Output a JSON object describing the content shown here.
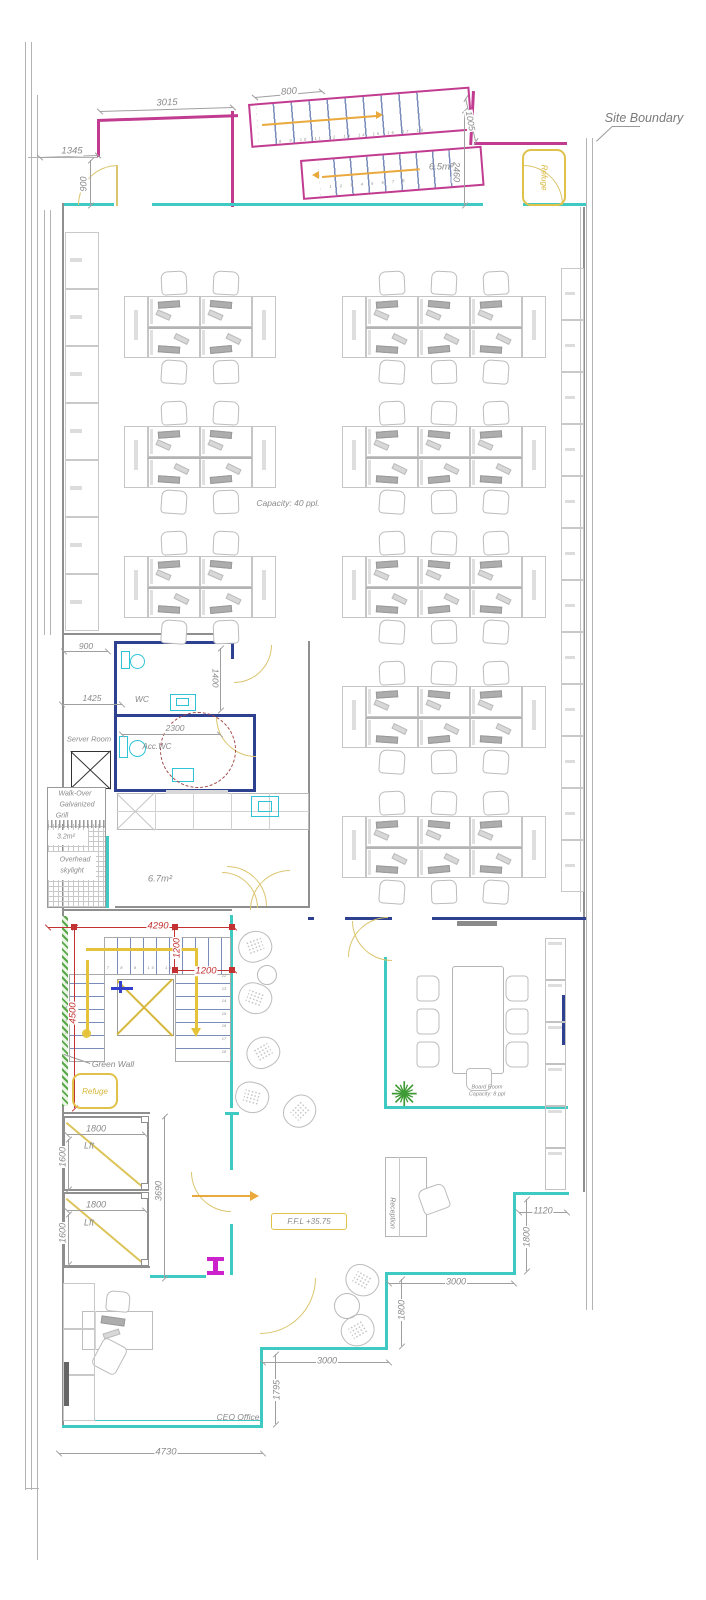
{
  "drawing": {
    "type": "office-floor-plan",
    "level_note": "F.F.L +35.75"
  },
  "boxes": {
    "refuge_top": {
      "label": "Refuge"
    },
    "refuge_stair": {
      "label": "Refuge"
    },
    "ffl": {
      "label": "F.F.L +35.75"
    }
  },
  "colors": {
    "glazing_teal": "#3ec9c2",
    "partition_navy": "#2e4090",
    "stair_pink": "#c13c90",
    "tread_blue": "#7a8cba",
    "door_yellow": "#dbc56e",
    "accent_yellow": "#d8b73a",
    "arrow_orange": "#e9a93d",
    "dim_red": "#c23232",
    "green_wall": "#3f9b35",
    "fixture_cyan": "#2ec4d6",
    "column_magenta": "#cc22cc",
    "wall_gray": "#8f8f8f"
  },
  "annotations": [
    {
      "name": "site-boundary-label",
      "text": "Site Boundary",
      "cx": 644,
      "cy": 118,
      "size": 12.5,
      "color": "#7a7a7a"
    },
    {
      "name": "dim-3015",
      "text": "3015",
      "cx": 167,
      "cy": 103,
      "size": 9.5,
      "rot": -2,
      "dim": true
    },
    {
      "name": "dim-800",
      "text": "800",
      "cx": 289,
      "cy": 92,
      "size": 9.5,
      "rot": -5,
      "dim": true
    },
    {
      "name": "dim-1005",
      "text": "1005",
      "cx": 470,
      "cy": 121,
      "size": 9,
      "rot": 80,
      "dim": true
    },
    {
      "name": "dim-2460",
      "text": "2460",
      "cx": 456,
      "cy": 172,
      "size": 9,
      "rot": 90,
      "dim": true
    },
    {
      "name": "dim-1345",
      "text": "1345",
      "cx": 72,
      "cy": 151,
      "size": 9.5,
      "dim": true
    },
    {
      "name": "dim-900-nw",
      "text": "900",
      "cx": 84,
      "cy": 184,
      "size": 9,
      "rot": -90,
      "dim": true
    },
    {
      "name": "area-stair-landing",
      "text": "6.5m²",
      "cx": 441,
      "cy": 167,
      "size": 9.5
    },
    {
      "name": "capacity-note",
      "text": "Capacity: 40 ppl.",
      "cx": 288,
      "cy": 503,
      "size": 8.5
    },
    {
      "name": "dim-900-wc",
      "text": "900",
      "cx": 86,
      "cy": 646,
      "size": 8.5,
      "dim": true
    },
    {
      "name": "room-wc",
      "text": "WC",
      "cx": 142,
      "cy": 699,
      "size": 8.5
    },
    {
      "name": "dim-1400",
      "text": "1400",
      "cx": 215,
      "cy": 678,
      "size": 8.5,
      "rot": 90,
      "dim": true
    },
    {
      "name": "dim-1425",
      "text": "1425",
      "cx": 92,
      "cy": 698,
      "size": 8.5,
      "dim": true
    },
    {
      "name": "dim-2300",
      "text": "2300",
      "cx": 175,
      "cy": 728,
      "size": 8.5,
      "dim": true
    },
    {
      "name": "room-server",
      "text": "Server Room",
      "cx": 89,
      "cy": 739,
      "size": 7.5
    },
    {
      "name": "room-acc-wc",
      "text": "Acc.WC",
      "cx": 157,
      "cy": 747,
      "size": 8
    },
    {
      "name": "note-walkover-1",
      "text": "Walk-Over",
      "cx": 75,
      "cy": 794,
      "size": 7
    },
    {
      "name": "note-walkover-2",
      "text": "Galvanized",
      "cx": 77,
      "cy": 805,
      "size": 7
    },
    {
      "name": "note-walkover-3",
      "text": "Grill",
      "cx": 62,
      "cy": 816,
      "size": 7
    },
    {
      "name": "area-skylight",
      "text": "3.2m²",
      "cx": 66,
      "cy": 837,
      "size": 7
    },
    {
      "name": "note-overhead-1",
      "text": "Overhead",
      "cx": 75,
      "cy": 860,
      "size": 7
    },
    {
      "name": "note-overhead-2",
      "text": "skylight",
      "cx": 72,
      "cy": 871,
      "size": 7
    },
    {
      "name": "area-kitchen",
      "text": "6.7m²",
      "cx": 160,
      "cy": 879,
      "size": 9.5
    },
    {
      "name": "dim-4290",
      "text": "4290",
      "cx": 158,
      "cy": 926,
      "size": 9.5,
      "color": "#c23232",
      "dim": true
    },
    {
      "name": "dim-1200-v",
      "text": "1200",
      "cx": 177,
      "cy": 948,
      "size": 9,
      "rot": -90,
      "color": "#c23232",
      "dim": true
    },
    {
      "name": "dim-1200-h",
      "text": "1200",
      "cx": 206,
      "cy": 971,
      "size": 9.5,
      "color": "#c23232",
      "dim": true
    },
    {
      "name": "dim-4500",
      "text": "4500",
      "cx": 73,
      "cy": 1013,
      "size": 9.5,
      "rot": -90,
      "color": "#c23232",
      "dim": true
    },
    {
      "name": "label-green-wall",
      "text": "Green Wall",
      "cx": 113,
      "cy": 1064,
      "size": 8.5
    },
    {
      "name": "dim-1800-lift1",
      "text": "1800",
      "cx": 96,
      "cy": 1129,
      "size": 9,
      "dim": true
    },
    {
      "name": "label-lift1",
      "text": "Lft",
      "cx": 89,
      "cy": 1146,
      "size": 9
    },
    {
      "name": "dim-1600-lift1",
      "text": "1600",
      "cx": 63,
      "cy": 1157,
      "size": 9,
      "rot": -90,
      "dim": true
    },
    {
      "name": "dim-1800-lift2",
      "text": "1800",
      "cx": 96,
      "cy": 1205,
      "size": 9,
      "dim": true
    },
    {
      "name": "label-lift2",
      "text": "Lft",
      "cx": 89,
      "cy": 1223,
      "size": 9
    },
    {
      "name": "dim-1600-lift2",
      "text": "1600",
      "cx": 63,
      "cy": 1233,
      "size": 9,
      "rot": -90,
      "dim": true
    },
    {
      "name": "dim-3690",
      "text": "3690",
      "cx": 159,
      "cy": 1191,
      "size": 9,
      "rot": -90,
      "dim": true
    },
    {
      "name": "label-reception",
      "text": "Reception",
      "cx": 392,
      "cy": 1213,
      "size": 7,
      "rot": 90
    },
    {
      "name": "label-board-room",
      "text": "Board Room",
      "cx": 487,
      "cy": 1088,
      "size": 5.5
    },
    {
      "name": "label-board-capacity",
      "text": "Capacity: 8 ppl",
      "cx": 487,
      "cy": 1095,
      "size": 5.5
    },
    {
      "name": "dim-1120",
      "text": "1120",
      "cx": 543,
      "cy": 1211,
      "size": 9,
      "dim": true
    },
    {
      "name": "dim-1800-r1",
      "text": "1800",
      "cx": 527,
      "cy": 1237,
      "size": 9,
      "rot": -90,
      "dim": true
    },
    {
      "name": "dim-3000-r1",
      "text": "3000",
      "cx": 456,
      "cy": 1282,
      "size": 9,
      "dim": true
    },
    {
      "name": "dim-1800-r2",
      "text": "1800",
      "cx": 402,
      "cy": 1310,
      "size": 9,
      "rot": -90,
      "dim": true
    },
    {
      "name": "dim-3000-r2",
      "text": "3000",
      "cx": 327,
      "cy": 1361,
      "size": 9,
      "dim": true
    },
    {
      "name": "dim-1795",
      "text": "1795",
      "cx": 277,
      "cy": 1390,
      "size": 9,
      "rot": -90,
      "dim": true
    },
    {
      "name": "label-ceo-office",
      "text": "CEO Office",
      "cx": 238,
      "cy": 1417,
      "size": 8.5
    },
    {
      "name": "dim-4730",
      "text": "4730",
      "cx": 166,
      "cy": 1452,
      "size": 9.5,
      "dim": true
    },
    {
      "name": "stair-numbers-ext-upper",
      "text": "8  9  10  11  12  13  14  15  16  17  18",
      "cx": 352,
      "cy": 136,
      "size": 4,
      "rot": -4.5,
      "ls": 2
    },
    {
      "name": "stair-numbers-ext-lower",
      "text": "1  2  3  4  5  6  7  8",
      "cx": 368,
      "cy": 184,
      "size": 4,
      "rot": -4.5,
      "ls": 2
    },
    {
      "name": "stair-numbers-int-top",
      "text": "7   8   9   10   11",
      "cx": 140,
      "cy": 968,
      "size": 4,
      "ls": 2
    },
    {
      "name": "stair-numbers-int-right",
      "text": "12\n13\n14\n15\n16\n17\n18",
      "cx": 224,
      "cy": 1014,
      "size": 4,
      "stack": true
    },
    {
      "name": "stair-numbers-int-left",
      "text": "6\n5\n4\n3\n2",
      "cx": 66,
      "cy": 1008,
      "size": 4,
      "stack": true
    }
  ]
}
